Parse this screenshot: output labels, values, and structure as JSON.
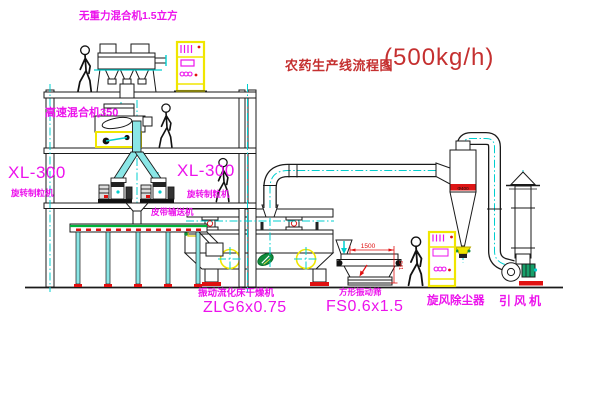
{
  "title": {
    "name": "农药生产线流程图",
    "capacity": "(500kg/h)"
  },
  "equipment_labels": {
    "gravity_mixer": "无重力混合机1.5立方",
    "high_speed_mixer": "高速混合机350",
    "granulator_left_model": "XL-300",
    "granulator_left_name": "旋转制粒机",
    "granulator_right_model": "XL-300",
    "granulator_right_name": "旋转制粒机",
    "belt_conveyor": "皮带输送机",
    "dryer_name": "振动流化床干燥机",
    "dryer_model": "ZLG6x0.75",
    "screen_name": "方形振动筛",
    "screen_model": "FS0.6x1.5",
    "cyclone": "旋风除尘器",
    "fan": "引风机"
  },
  "dimensions": {
    "screen_length": "1500",
    "screen_height": "541",
    "cyclone_diameter": "Φ400"
  },
  "colors": {
    "label_magenta": "#ec12ec",
    "title_red": "#c53030",
    "centerline_cyan": "#00cfcf",
    "highlight_yellow": "#f0e600",
    "accent_red": "#e01010",
    "belt_green": "#00b33c",
    "logo_green": "#0f8c3c"
  }
}
